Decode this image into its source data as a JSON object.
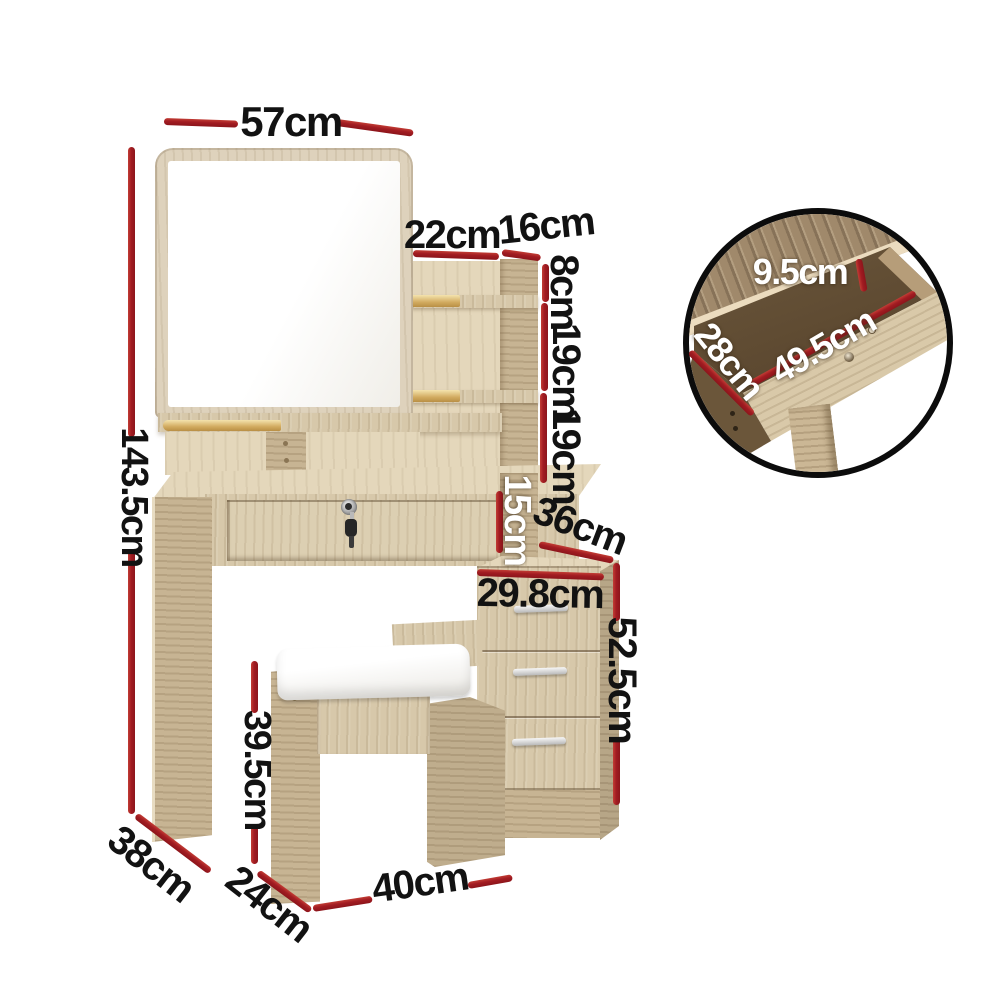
{
  "figure": {
    "type": "product-dimension-diagram",
    "subject": "dressing table set with mirror, side shelves, lockable drawer, 3-drawer cabinet and stool"
  },
  "colors": {
    "dimension_line_red": "#a21c22",
    "label_black": "#121212",
    "label_white": "#ffffff",
    "wood_light": "#d7c8aa",
    "inset_border_black": "#0c0c0c"
  },
  "dimensions": {
    "mirror_width": "57cm",
    "shelf_width": "22cm",
    "tower_depth": "16cm",
    "shelf_top_gap": "8cm",
    "shelf_gap_1": "19cm",
    "shelf_gap_2": "19cm",
    "overall_height": "143.5cm",
    "side_niche_height": "15cm",
    "cabinet_top_depth": "36cm",
    "cabinet_width": "29.8cm",
    "cabinet_height": "52.5cm",
    "stool_height": "39.5cm",
    "table_side_depth": "38cm",
    "stool_side_depth": "24cm",
    "stool_width": "40cm"
  },
  "inset": {
    "drawer_inner_height": "9.5cm",
    "drawer_inner_depth": "28cm",
    "drawer_inner_width": "49.5cm"
  }
}
